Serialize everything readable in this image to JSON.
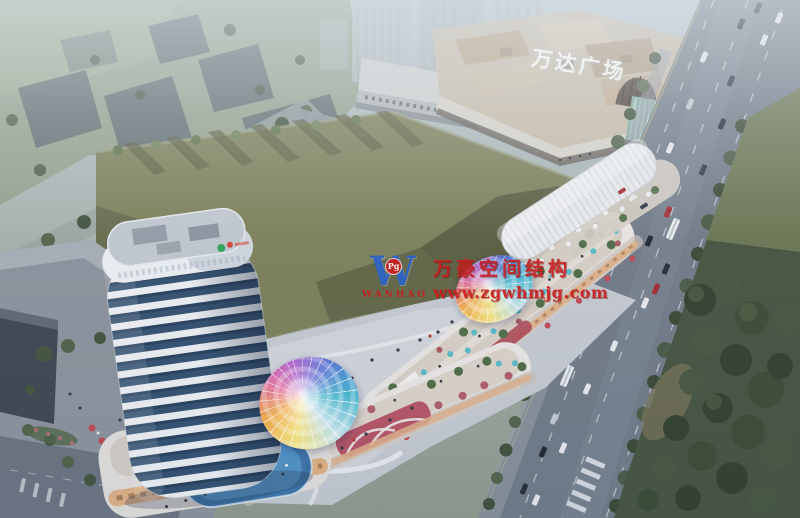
{
  "signs": {
    "mall_sign": "万达广场"
  },
  "watermark": {
    "logo_letter": "W",
    "logo_badge": "Pg",
    "logo_name": "WANHAO",
    "title": "万豪空间结构",
    "url": "www.zgwhmjg.com"
  },
  "palette": {
    "watermark_red": "#c81f1f",
    "logo_blue": "#2d64c8",
    "sign_white": "#f2f5f7",
    "lawn_green": "#7a7f55",
    "lawn_shadow": "#54593a",
    "park_green": "#43513c",
    "road_gray": "#6f7a85",
    "tower_glass": "#2e4d6d",
    "tower_white": "#eef2f5",
    "mall_roof_tan": "#c8bca8",
    "umbrella_teal": "#58bcc8",
    "umbrella_red": "#c14450",
    "canopy_yellow": "#f1e07c",
    "canopy_orange": "#f0ab4c",
    "canopy_magenta": "#e0659c",
    "canopy_purple": "#a958c8",
    "canopy_blue": "#5a70d4",
    "canopy_teal": "#41b2cc",
    "haze_blue": "#dfe9f0"
  }
}
